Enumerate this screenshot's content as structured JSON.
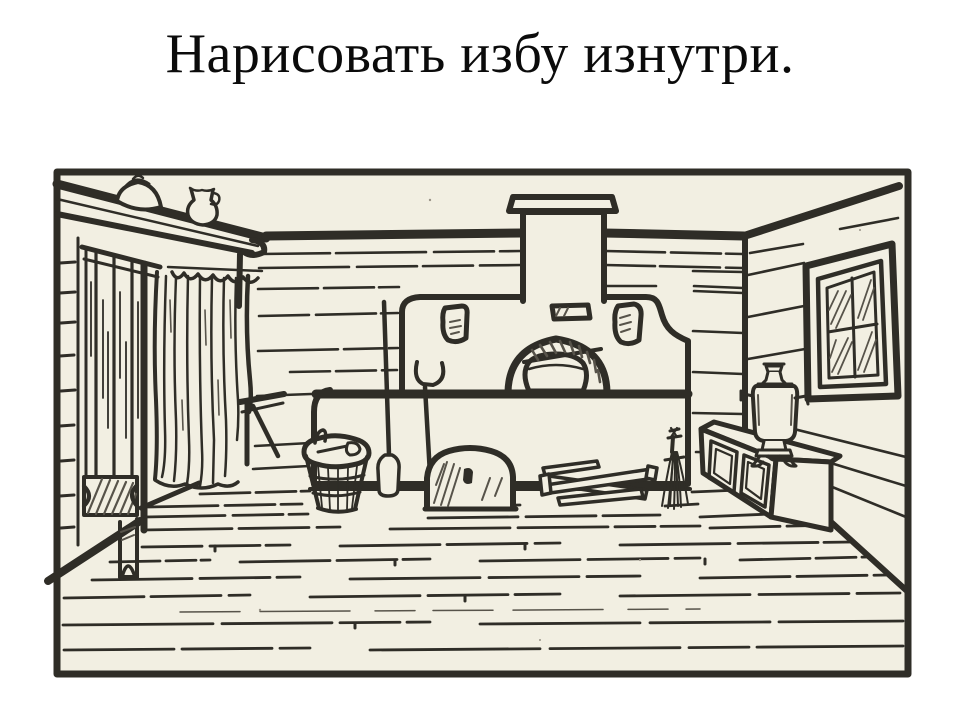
{
  "slide": {
    "title": "Нарисовать избу изнутри."
  },
  "colors": {
    "background": "#ffffff",
    "paper": "#f2efe2",
    "ink": "#2f2d27",
    "ink_soft": "#57534a",
    "title_text": "#0b0b0b"
  },
  "illustration": {
    "scene_objects": [
      "picture-frame",
      "log-walls",
      "ceiling-beam",
      "wall-shelf",
      "kettle",
      "jug",
      "plank-door",
      "curtain",
      "small-bench",
      "corner-bench",
      "russian-stove",
      "chimney",
      "hearth-arch",
      "hearth-pot",
      "oven-mitts",
      "stove-vent",
      "oven-fork",
      "bread-peel",
      "stove-damper",
      "wooden-bucket",
      "ladle",
      "firewood",
      "broom",
      "chest",
      "samovar",
      "window",
      "floorboards"
    ]
  }
}
